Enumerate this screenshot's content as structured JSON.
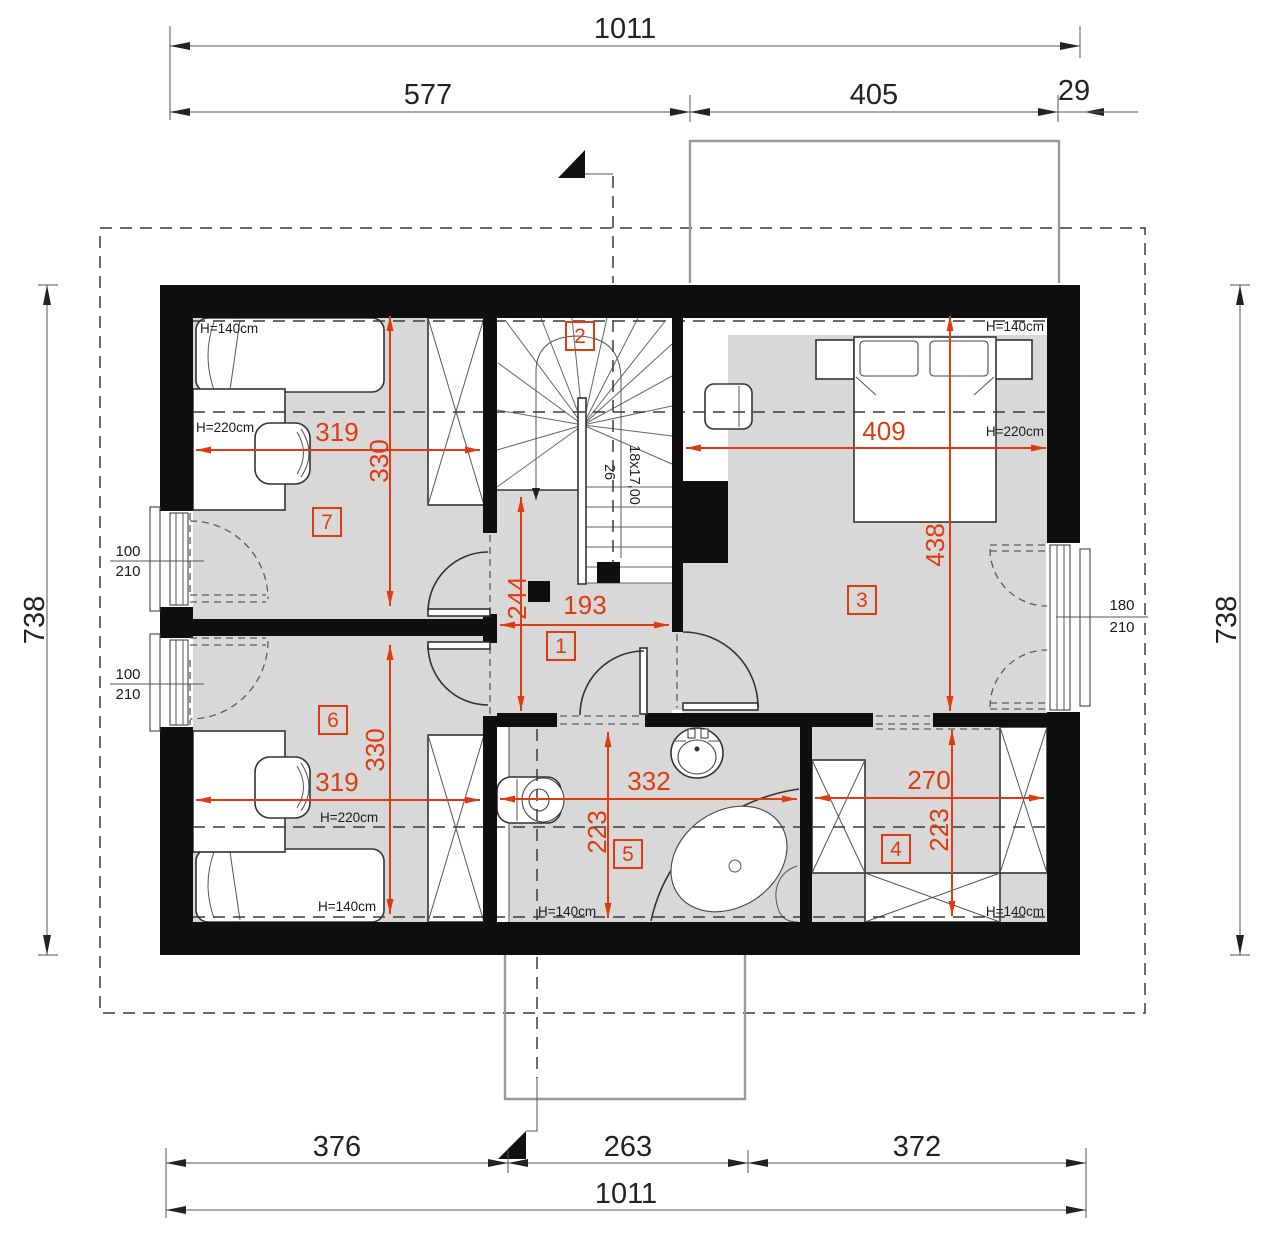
{
  "colors": {
    "dimension_red": "#e03a10",
    "wall_black": "#0f0f0f",
    "floor_gray": "#d8d8d8",
    "line_dark": "#333333",
    "outline_gray": "#9a9a9a"
  },
  "dims": {
    "top_total": "1011",
    "top_left": "577",
    "top_mid": "405",
    "top_right": "29",
    "bottom_left": "376",
    "bottom_mid": "263",
    "bottom_right": "372",
    "bottom_total": "1011",
    "side_left": "738",
    "side_right": "738"
  },
  "rooms": {
    "r1": {
      "id": "1",
      "width": "193",
      "height": "244"
    },
    "r2": {
      "id": "2",
      "stair_note": "18x17,00",
      "stair_tread": "26"
    },
    "r3": {
      "id": "3",
      "width": "409",
      "height": "438"
    },
    "r4": {
      "id": "4",
      "width": "270",
      "height": "223"
    },
    "r5": {
      "id": "5",
      "width": "332",
      "height": "223"
    },
    "r6": {
      "id": "6",
      "width": "319",
      "height": "330"
    },
    "r7": {
      "id": "7",
      "width": "319",
      "height": "330"
    }
  },
  "heights": {
    "h140": "H=140cm",
    "h220": "H=220cm"
  },
  "openings": {
    "left_windows": [
      {
        "w": "100",
        "h": "210"
      },
      {
        "w": "100",
        "h": "210"
      }
    ],
    "balcony_door": {
      "w": "180",
      "h": "210"
    }
  }
}
